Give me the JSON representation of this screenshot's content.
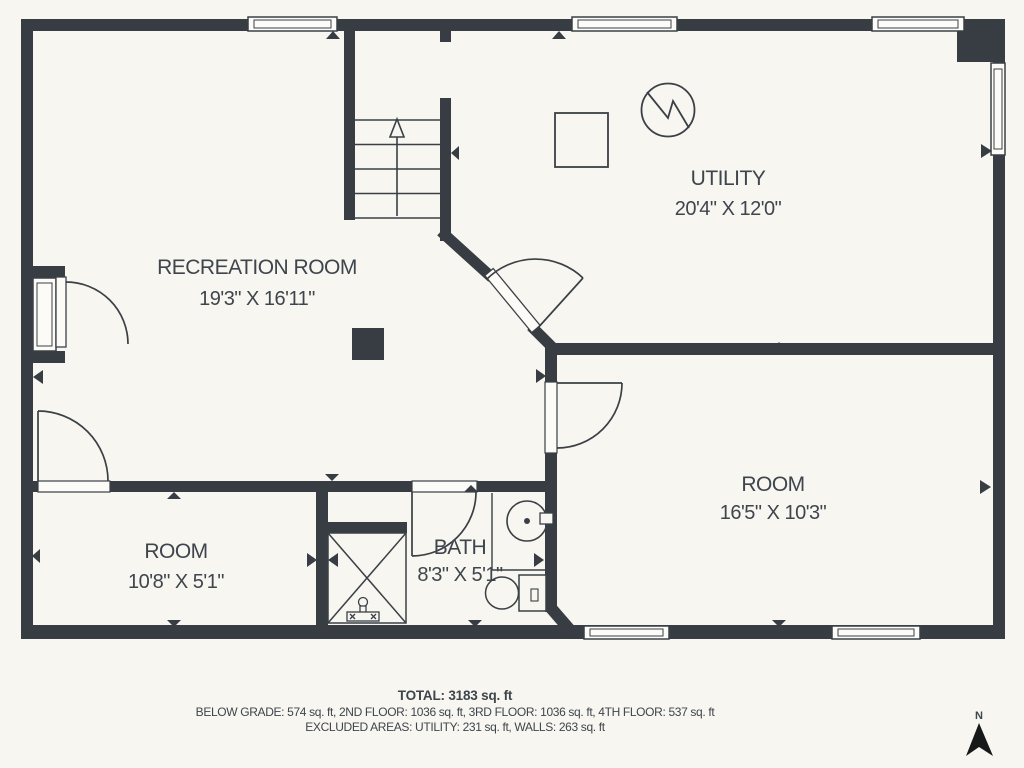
{
  "plan": {
    "rooms": [
      {
        "name": "RECREATION ROOM",
        "dims": "19'3\" X 16'11\""
      },
      {
        "name": "UTILITY",
        "dims": "20'4\" X 12'0\""
      },
      {
        "name": "ROOM",
        "dims": "16'5\" X 10'3\""
      },
      {
        "name": "ROOM",
        "dims": "10'8\" X 5'1\""
      },
      {
        "name": "BATH",
        "dims": "8'3\" X 5'1\""
      }
    ],
    "summary": {
      "total": "TOTAL: 3183 sq. ft",
      "floors": "BELOW GRADE: 574 sq. ft, 2ND FLOOR: 1036 sq. ft, 3RD FLOOR: 1036 sq. ft, 4TH FLOOR: 537 sq. ft",
      "excluded": "EXCLUDED AREAS: UTILITY: 231 sq. ft, WALLS: 263 sq. ft"
    },
    "compass": {
      "label": "N"
    },
    "colors": {
      "background": "#f7f6f0",
      "wall": "#373d43",
      "line": "#3a4046",
      "text": "#3e454c",
      "window_fill": "#fcfbf7"
    }
  }
}
